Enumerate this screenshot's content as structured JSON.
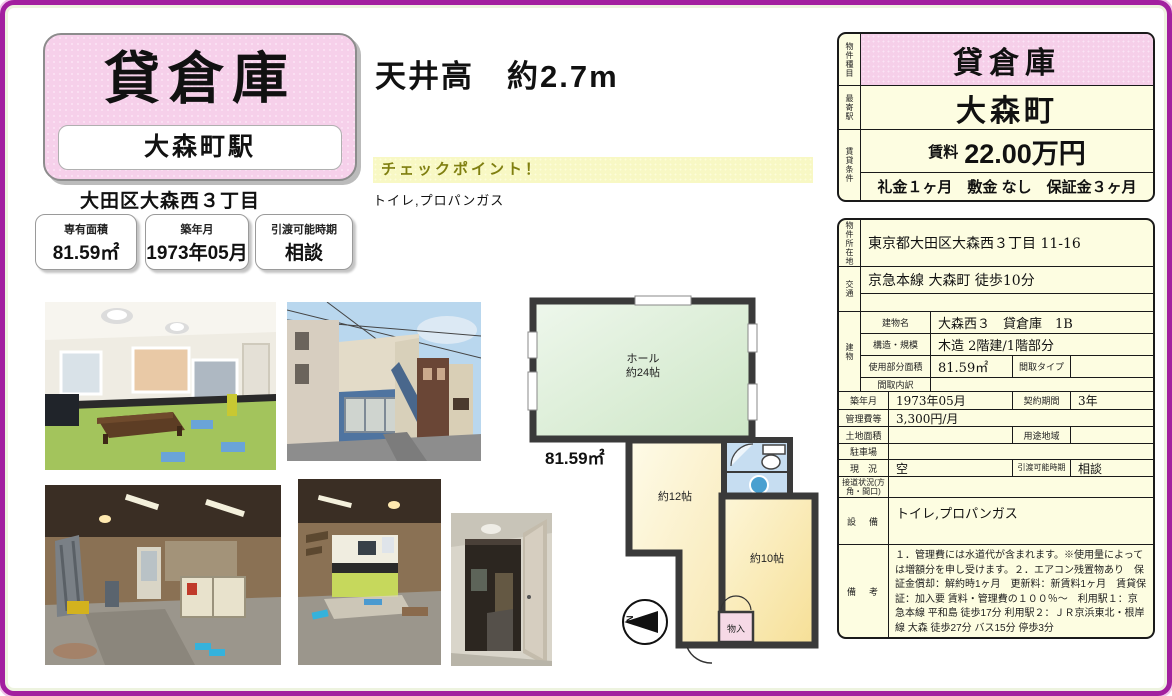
{
  "title_block": {
    "type": "貸倉庫",
    "station": "大森町駅",
    "address": "大田区大森西３丁目"
  },
  "stats": [
    {
      "label": "専有面積",
      "value": "81.59㎡"
    },
    {
      "label": "築年月",
      "value": "1973年05月"
    },
    {
      "label": "引渡可能時期",
      "value": "相談"
    }
  ],
  "highlight": {
    "ceiling": "天井高　約2.7m",
    "checkpoint_title": "チェックポイント！",
    "checkpoint_text": "トイレ,プロパンガス"
  },
  "summary": {
    "type_label": "物件種目",
    "type": "貸倉庫",
    "station_label": "最寄駅",
    "station": "大森町",
    "terms_label": "賃貸条件",
    "rent_label": "賃料",
    "rent": "22.00万円",
    "terms": "礼金１ヶ月　敷金 なし　保証金３ヶ月"
  },
  "detail": {
    "location_label": "物件所在地",
    "location": "東京都大田区大森西３丁目 11-16",
    "access_label": "交通",
    "access": "京急本線 大森町 徒歩10分",
    "access2": "",
    "building_label": "建物",
    "building_name_label": "建物名",
    "building_name": "大森西３　貸倉庫　1B",
    "structure_label": "構造・規模",
    "structure": "木造 2階建/1階部分",
    "area_label": "使用部分面積",
    "area": "81.59㎡",
    "madori_type_label": "間取タイプ",
    "madori_type": "",
    "madori_breakdown_label": "間取内訳",
    "madori_breakdown": "",
    "built_label": "築年月",
    "built": "1973年05月",
    "contract_label": "契約期間",
    "contract": "3年",
    "fee_label": "管理費等",
    "fee": "3,300円/月",
    "land_label": "土地面積",
    "land": "",
    "zoning_label": "用途地域",
    "zoning": "",
    "parking_label": "駐車場",
    "parking": "",
    "status_label": "現　況",
    "status": "空",
    "handover_label": "引渡可能時期",
    "handover": "相談",
    "road_label": "接道状況(方角・間口)",
    "road": "",
    "equipment_label": "設　備",
    "equipment": "トイレ,プロパンガス",
    "remarks_label": "備　考",
    "remarks": "１．管理費には水道代が含まれます。※使用量によっては増額分を申し受けます。２．エアコン残置物あり　保証金償却：解約時1ヶ月　更新料：新賃料1ヶ月　賃貸保証：加入要 賃料・管理費の１００％～　利用駅１：京急本線 平和島 徒歩17分 利用駅２：ＪＲ京浜東北・根岸線 大森 徒歩27分 バス15分 停歩3分"
  },
  "floorplan": {
    "hall_line1": "ホール",
    "hall_line2": "約24帖",
    "total_area": "81.59㎡",
    "room12": "約12帖",
    "room10": "約10帖",
    "closet": "物入",
    "compass": "N"
  }
}
